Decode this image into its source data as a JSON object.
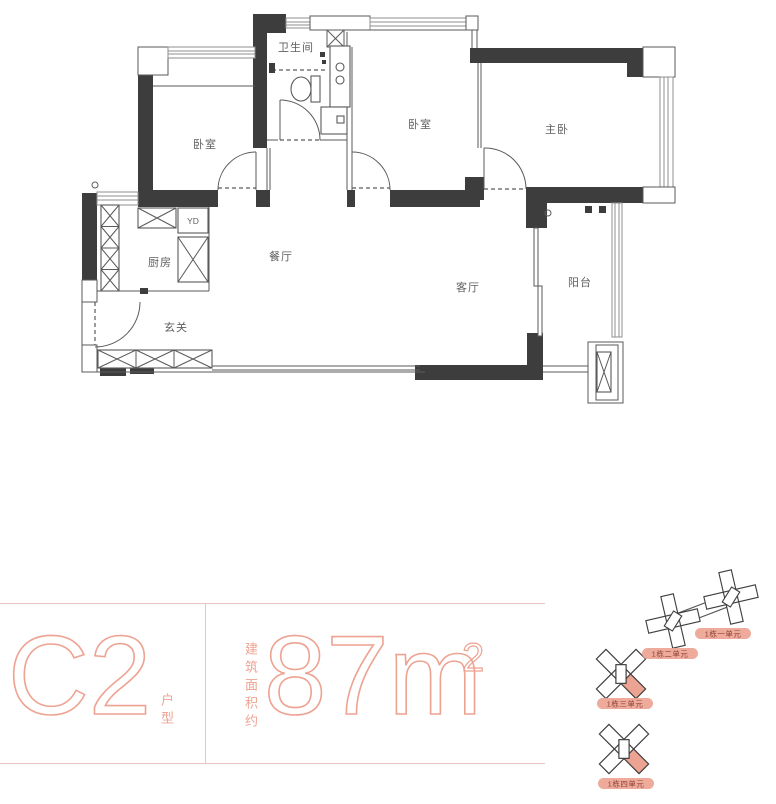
{
  "palette": {
    "accent": "#eda392",
    "hairline": "#e9c6bc",
    "wall": "#3d3d3d",
    "pill_text": "#8d4236",
    "room_label": "#5f5f5f"
  },
  "plan": {
    "rooms": [
      {
        "label": "卧室"
      },
      {
        "label": "卫生间"
      },
      {
        "label": "卧室"
      },
      {
        "label": "主卧"
      },
      {
        "label": "厨房"
      },
      {
        "label": "餐厅"
      },
      {
        "label": "客厅"
      },
      {
        "label": "阳台"
      },
      {
        "label": "玄关"
      },
      {
        "label": "YD"
      }
    ]
  },
  "info": {
    "unit_code": "C2",
    "unit_type_label": "户型",
    "area_prefix": "建筑面积约",
    "area_value": "87m",
    "area_exponent": "2"
  },
  "keyplans": [
    {
      "label": "1栋一单元",
      "highlight": false
    },
    {
      "label": "1栋二单元",
      "highlight": false
    },
    {
      "label": "1栋三单元",
      "highlight": true
    },
    {
      "label": "1栋四单元",
      "highlight": true
    }
  ]
}
